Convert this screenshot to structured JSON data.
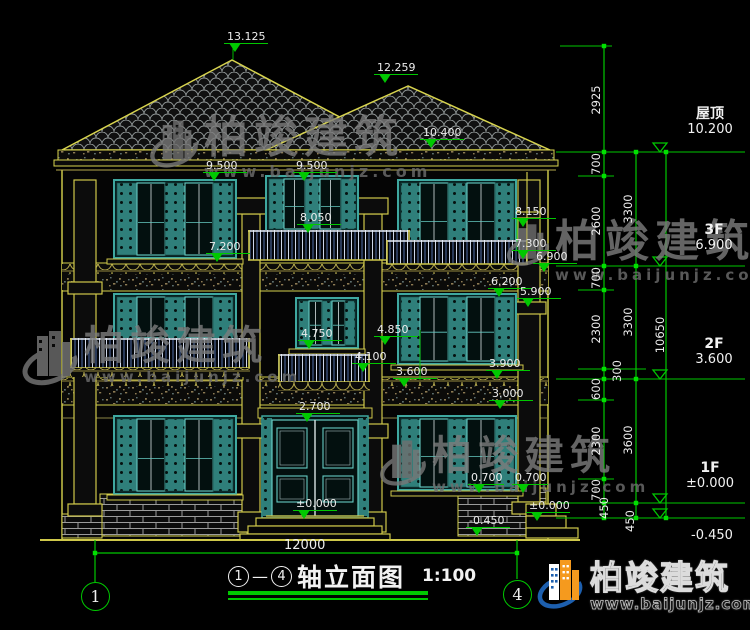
{
  "title": {
    "axis_start": "1",
    "separator": "—",
    "axis_end": "4",
    "text": "轴立面图",
    "scale": "1:100"
  },
  "axes": {
    "left_bubble": "1",
    "right_bubble": "4",
    "span_dim": "12000"
  },
  "watermark": {
    "brand": "柏竣建筑",
    "site": "www.baijunjz.com"
  },
  "logo": {
    "brand": "柏竣建筑",
    "site": "www.baijunjz.com"
  },
  "colors": {
    "cad_yellow": "#d8d44e",
    "cad_green": "#00c800",
    "window_teal": "#3fa8a0",
    "text_white": "#ececec",
    "logo_blue": "#1d5fae",
    "logo_orange": "#f59a1e"
  },
  "elevation_markers": [
    {
      "label": "13.125",
      "x": 224,
      "y": 43
    },
    {
      "label": "12.259",
      "x": 374,
      "y": 74
    },
    {
      "label": "10.400",
      "x": 420,
      "y": 139
    },
    {
      "label": "9.500",
      "x": 203,
      "y": 172
    },
    {
      "label": "9.500",
      "x": 293,
      "y": 172
    },
    {
      "label": "8.050",
      "x": 297,
      "y": 224
    },
    {
      "label": "7.200",
      "x": 206,
      "y": 253
    },
    {
      "label": "8.150",
      "x": 512,
      "y": 218
    },
    {
      "label": "7.300",
      "x": 512,
      "y": 250
    },
    {
      "label": "6.900",
      "x": 533,
      "y": 263
    },
    {
      "label": "6.200",
      "x": 488,
      "y": 288
    },
    {
      "label": "5.900",
      "x": 517,
      "y": 298
    },
    {
      "label": "4.750",
      "x": 298,
      "y": 340
    },
    {
      "label": "4.850",
      "x": 374,
      "y": 336
    },
    {
      "label": "4.100",
      "x": 352,
      "y": 363
    },
    {
      "label": "3.600",
      "x": 393,
      "y": 378
    },
    {
      "label": "3.900",
      "x": 486,
      "y": 370
    },
    {
      "label": "3.000",
      "x": 489,
      "y": 400
    },
    {
      "label": "2.700",
      "x": 296,
      "y": 413
    },
    {
      "label": "0.700",
      "x": 468,
      "y": 484,
      "w": 36
    },
    {
      "label": "0.700",
      "x": 512,
      "y": 484,
      "w": 36
    },
    {
      "label": "±0.000",
      "x": 293,
      "y": 510
    },
    {
      "label": "±0.000",
      "x": 526,
      "y": 512
    },
    {
      "label": "-0.450",
      "x": 466,
      "y": 527
    }
  ],
  "dim_chains": {
    "inner": [
      {
        "label": "2925",
        "x": 596,
        "y": 100
      },
      {
        "label": "700",
        "x": 596,
        "y": 164
      },
      {
        "label": "2600",
        "x": 596,
        "y": 221
      },
      {
        "label": "700",
        "x": 596,
        "y": 278
      },
      {
        "label": "2300",
        "x": 596,
        "y": 329
      },
      {
        "label": "300",
        "x": 617,
        "y": 371
      },
      {
        "label": "600",
        "x": 596,
        "y": 389
      },
      {
        "label": "2300",
        "x": 596,
        "y": 441
      },
      {
        "label": "700",
        "x": 596,
        "y": 490
      },
      {
        "label": "450",
        "x": 604,
        "y": 508
      }
    ],
    "middle": [
      {
        "label": "3300",
        "x": 628,
        "y": 209
      },
      {
        "label": "3300",
        "x": 628,
        "y": 322
      },
      {
        "label": "3600",
        "x": 628,
        "y": 440
      },
      {
        "label": "450",
        "x": 630,
        "y": 521
      }
    ],
    "overall": [
      {
        "label": "10650",
        "x": 660,
        "y": 335
      }
    ]
  },
  "level_labels": [
    {
      "name": "屋顶",
      "value": "10.200",
      "x": 672,
      "y": 106
    },
    {
      "name": "3F",
      "value": "6.900",
      "x": 676,
      "y": 222
    },
    {
      "name": "2F",
      "value": "3.600",
      "x": 676,
      "y": 336
    },
    {
      "name": "1F",
      "value": "±0.000",
      "x": 672,
      "y": 460
    },
    {
      "name": "",
      "value": "-0.450",
      "x": 674,
      "y": 528
    }
  ]
}
